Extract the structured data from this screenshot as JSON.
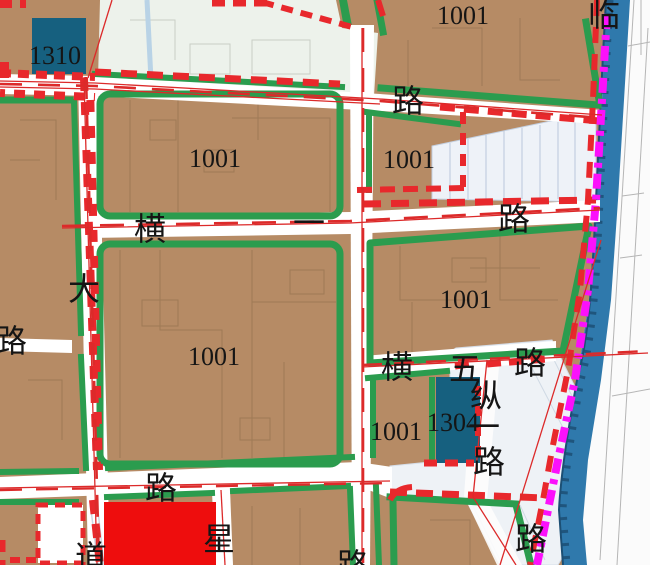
{
  "map": {
    "type": "urban-zoning-plan",
    "parcel_codes_visible": [
      "1310",
      "1001",
      "1304"
    ],
    "colors": {
      "parcel_brown": "#b68b65",
      "parcel_detail_line": "#9a7753",
      "parcel_dark_blue": "#16607f",
      "parcel_red": "#ee0d0d",
      "green_belt": "#2b9c4e",
      "road_white": "#ffffff",
      "red_boundary_dash": "#e8282c",
      "red_centerline": "#dc2a2a",
      "magenta_boundary": "#fb10fb",
      "river_blue": "#2f79ac",
      "river_edge_dark": "#1c4f74",
      "light_green_area": "#edf2eb",
      "light_blue_area": "#eef2f8",
      "light_blue_line": "#c3cfe0",
      "offplan_line_grey": "#b5b5b5",
      "label_black": "#151515"
    }
  },
  "labels": [
    {
      "text": "1310",
      "role": "parcel-code"
    },
    {
      "text": "1001",
      "role": "parcel-code"
    },
    {
      "text": "临",
      "role": "road-name-char"
    },
    {
      "text": "路",
      "role": "road-name-char"
    },
    {
      "text": "1001",
      "role": "parcel-code"
    },
    {
      "text": "1001",
      "role": "parcel-code"
    },
    {
      "text": "横",
      "role": "road-name-char"
    },
    {
      "text": "一",
      "role": "road-name-char"
    },
    {
      "text": "路",
      "role": "road-name-char"
    },
    {
      "text": "大",
      "role": "road-name-char"
    },
    {
      "text": "路",
      "role": "road-name-char"
    },
    {
      "text": "1001",
      "role": "parcel-code"
    },
    {
      "text": "1001",
      "role": "parcel-code"
    },
    {
      "text": "横",
      "role": "road-name-char"
    },
    {
      "text": "五",
      "role": "road-name-char"
    },
    {
      "text": "路",
      "role": "road-name-char"
    },
    {
      "text": "纵",
      "role": "road-name-char"
    },
    {
      "text": "1304",
      "role": "parcel-code"
    },
    {
      "text": "一",
      "role": "road-name-char"
    },
    {
      "text": "1001",
      "role": "parcel-code"
    },
    {
      "text": "路",
      "role": "road-name-char"
    },
    {
      "text": "路",
      "role": "road-name-char"
    },
    {
      "text": "星",
      "role": "road-name-char"
    },
    {
      "text": "道",
      "role": "road-name-char"
    },
    {
      "text": "路",
      "role": "road-name-char"
    },
    {
      "text": "路",
      "role": "road-name-char"
    }
  ]
}
